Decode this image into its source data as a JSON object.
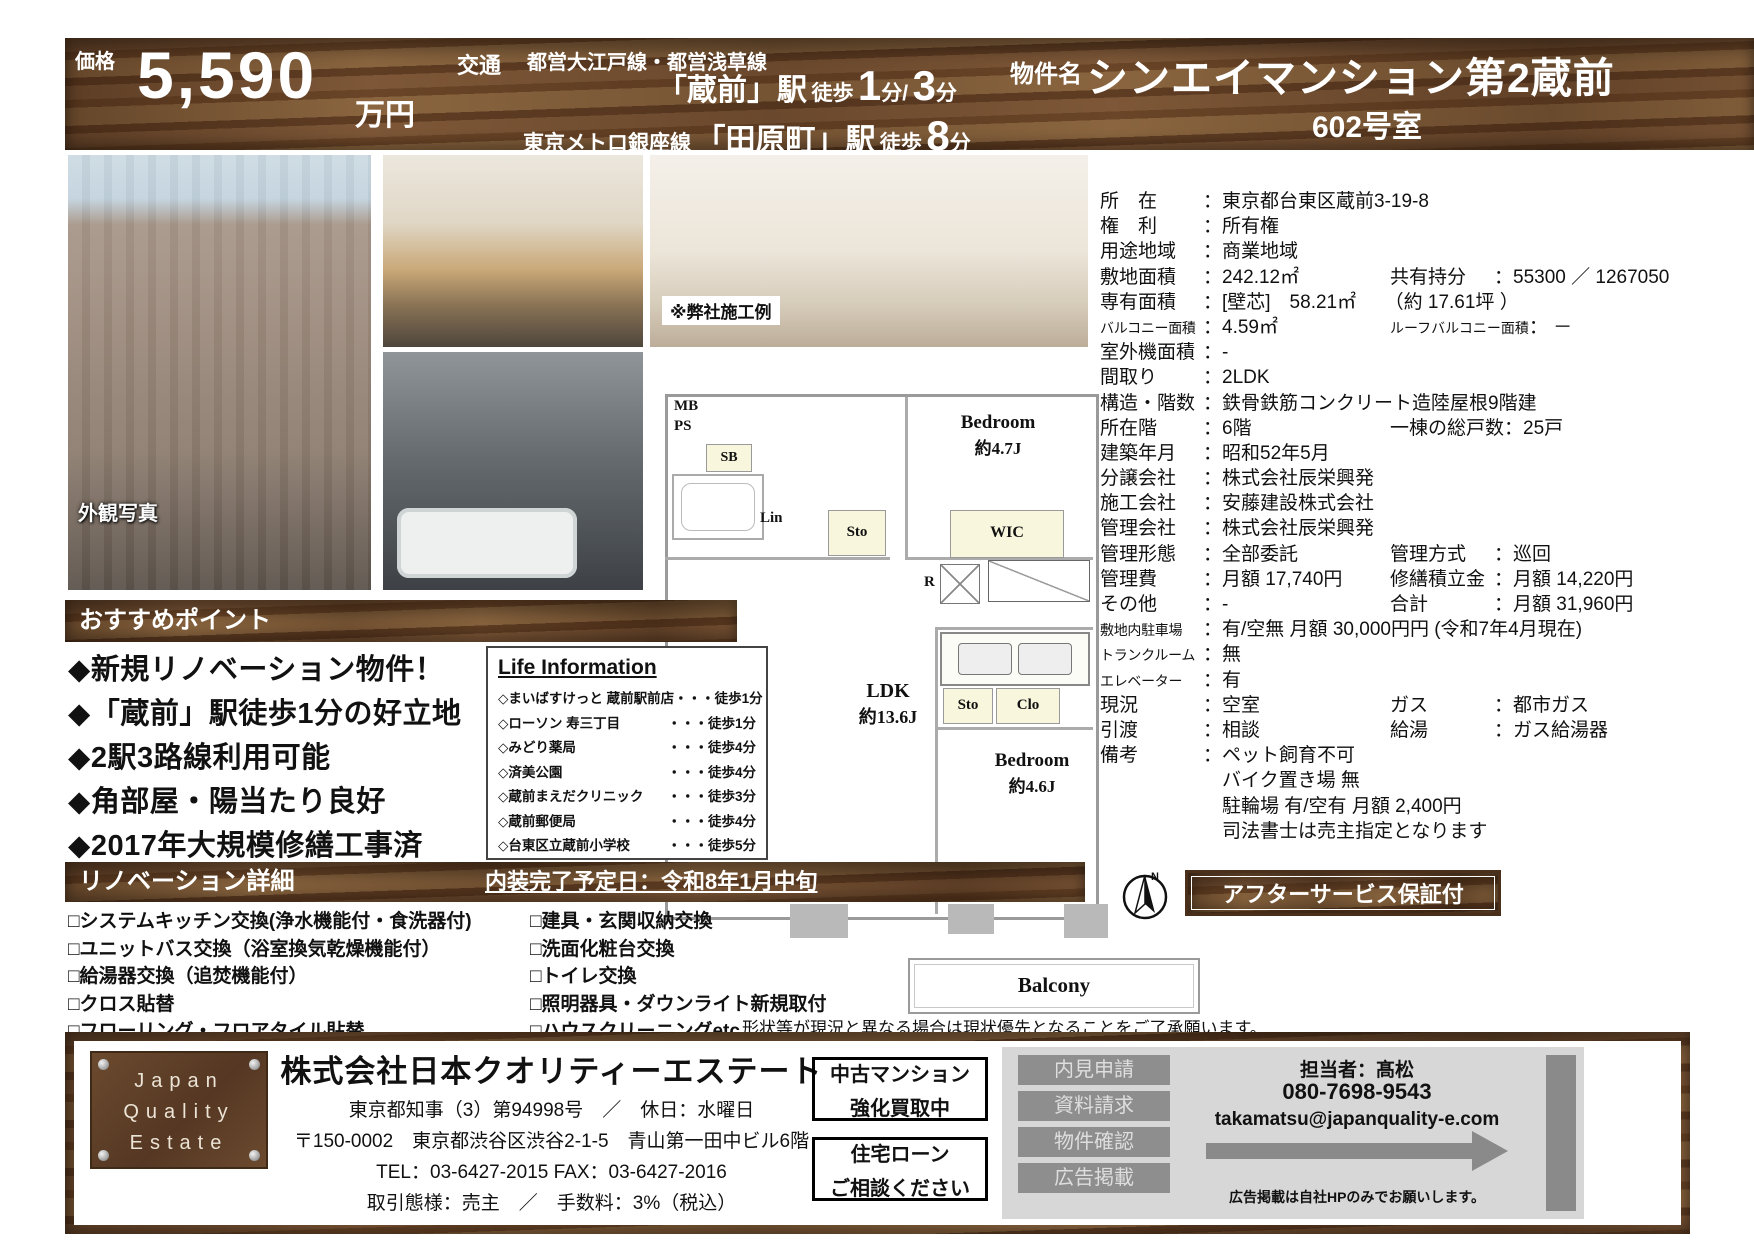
{
  "header": {
    "price_label": "価格",
    "price_value": "5,590",
    "price_unit": "万円",
    "transport_label": "交通",
    "line1_railways": "都営大江戸線・都営浅草線",
    "line1_station": "「蔵前」駅",
    "line1_walk_label": "徒歩",
    "line1_min1": "1",
    "line1_sep": "分/",
    "line1_min2": "3",
    "line1_unit": "分",
    "line2_railway": "東京メトロ銀座線",
    "line2_station": "「田原町」駅",
    "line2_walk_label": "徒歩",
    "line2_min": "8",
    "line2_unit": "分",
    "property_label": "物件名",
    "property_name": "シンエイマンション第2蔵前",
    "room": "602号室"
  },
  "photos": {
    "exterior_label": "外観写真",
    "example_note": "※弊社施工例"
  },
  "details": {
    "rows": [
      {
        "l": "所　在",
        "v": "：東京都台東区蔵前3-19-8"
      },
      {
        "l": "権　利",
        "v": "：所有権"
      },
      {
        "l": "用途地域",
        "v": "：商業地域"
      },
      {
        "l": "敷地面積",
        "v": "：242.12㎡",
        "l2": "共有持分",
        "v2": "：55300 ／ 1267050"
      },
      {
        "l": "専有面積",
        "v": "：[壁芯]　58.21㎡　　（約 17.61坪 ）"
      },
      {
        "l": "バルコニー面積",
        "v": "：4.59㎡",
        "l2": "ルーフバルコニー面積",
        "v2": "： －",
        "_cls": "sm"
      },
      {
        "l": "室外機面積",
        "v": "：-"
      },
      {
        "l": "間取り",
        "v": "：2LDK"
      },
      {
        "l": "構造・階数",
        "v": "：鉄骨鉄筋コンクリート造陸屋根9階建"
      },
      {
        "l": "所在階",
        "v": "：6階",
        "l2": "一棟の総戸数",
        "v2": "：25戸"
      },
      {
        "l": "建築年月",
        "v": "：昭和52年5月"
      },
      {
        "l": "分譲会社",
        "v": "：株式会社辰栄興発"
      },
      {
        "l": "施工会社",
        "v": "：安藤建設株式会社"
      },
      {
        "l": "管理会社",
        "v": "：株式会社辰栄興発"
      },
      {
        "l": "管理形態",
        "v": "：全部委託",
        "l2": "管理方式",
        "v2": "：巡回"
      },
      {
        "l": "管理費",
        "v": "：月額 17,740円",
        "l2": "修繕積立金",
        "v2": "：月額 14,220円"
      },
      {
        "l": "その他",
        "v": "：-",
        "l2": "合計",
        "v2": "：月額 31,960円"
      },
      {
        "l": "敷地内駐車場",
        "v": "：有/空無  月額 30,000円円 (令和7年4月現在)",
        "_cls": "sm"
      },
      {
        "l": "トランクルーム",
        "v": "：無",
        "_cls": "sm"
      },
      {
        "l": "エレベーター",
        "v": "：有",
        "_cls": "sm"
      },
      {
        "l": "現況",
        "v": "：空室",
        "l2": "ガス",
        "v2": "：都市ガス"
      },
      {
        "l": "引渡",
        "v": "：相談",
        "l2": "給湯",
        "v2": "：ガス給湯器"
      },
      {
        "l": "備考",
        "v": "：ペット飼育不可"
      },
      {
        "l": "",
        "v": "　バイク置き場  無"
      },
      {
        "l": "",
        "v": "　駐輪場  有/空有  月額 2,400円"
      },
      {
        "l": "",
        "v": "　司法書士は売主指定となります"
      }
    ]
  },
  "points": {
    "title": "おすすめポイント",
    "items": [
      "新規リノベーション物件！",
      "「蔵前」駅徒歩1分の好立地",
      "2駅3路線利用可能",
      "角部屋・陽当たり良好",
      "2017年大規模修繕工事済"
    ]
  },
  "life": {
    "title": "Life Information",
    "items": [
      {
        "name": "まいばすけっと 蔵前駅前店",
        "walk": "徒歩1分"
      },
      {
        "name": "ローソン 寿三丁目",
        "walk": "徒歩1分"
      },
      {
        "name": "みどり薬局",
        "walk": "徒歩4分"
      },
      {
        "name": "済美公園",
        "walk": "徒歩4分"
      },
      {
        "name": "蔵前まえだクリニック",
        "walk": "徒歩3分"
      },
      {
        "name": "蔵前郵便局",
        "walk": "徒歩4分"
      },
      {
        "name": "台東区立蔵前小学校",
        "walk": "徒歩5分"
      }
    ]
  },
  "reno": {
    "title": "リノベーション詳細",
    "date": "内装完了予定日：令和8年1月中旬",
    "left": [
      "システムキッチン交換(浄水機能付・食洗器付)",
      "ユニットバス交換（浴室換気乾燥機能付）",
      "給湯器交換（追焚機能付）",
      "クロス貼替",
      "フローリング・フロアタイル貼替"
    ],
    "right": [
      "建具・玄関収納交換",
      "洗面化粧台交換",
      "トイレ交換",
      "照明器具・ダウンライト新規取付",
      "ハウスクリーニングetc..."
    ]
  },
  "plan": {
    "labels": {
      "mb": "MB",
      "ps": "PS",
      "sb": "SB",
      "lin": "Lin",
      "sto_a": "Sto",
      "wic": "WIC",
      "r": "R",
      "bed1": "Bedroom",
      "bed1_size": "約4.7J",
      "ldk": "LDK",
      "ldk_size": "約13.6J",
      "sto_b": "Sto",
      "clo": "Clo",
      "bed2": "Bedroom",
      "bed2_size": "約4.6J",
      "balcony": "Balcony"
    },
    "compass_n": "N",
    "note": "形状等が現況と異なる場合は現状優先となることをご了承願います。"
  },
  "after_service": "アフターサービス保証付",
  "footer": {
    "logo": [
      "Japan",
      "Quality",
      "Estate"
    ],
    "company": "株式会社日本クオリティーエステート",
    "license": "東京都知事（3）第94998号　／　休日：水曜日",
    "address": "〒150-0002　東京都渋谷区渋谷2-1-5　青山第一田中ビル6階",
    "tel": "TEL：03-6427-2015  FAX：03-6427-2016",
    "terms": "取引態様：売主　／　手数料：3%（税込）",
    "box1": [
      "中古マンション",
      "強化買取中"
    ],
    "box2": [
      "住宅ローン",
      "ご相談ください"
    ],
    "buttons": [
      "内見申請",
      "資料請求",
      "物件確認",
      "広告掲載"
    ],
    "contact": {
      "person": "担当者：髙松",
      "phone": "080-7698-9543",
      "email": "takamatsu@japanquality-e.com",
      "note": "広告掲載は自社HPのみでお願いします。"
    }
  },
  "glyphs": {
    "bullet": "◆",
    "diamond": "◇",
    "checkbox": "□",
    "dots": "・・・"
  },
  "colors": {
    "wood": "#6f4c2c",
    "button_gray": "#8e8e8e",
    "panel_gray": "#d7d7d7",
    "pale_room": "#f8f6dd"
  }
}
